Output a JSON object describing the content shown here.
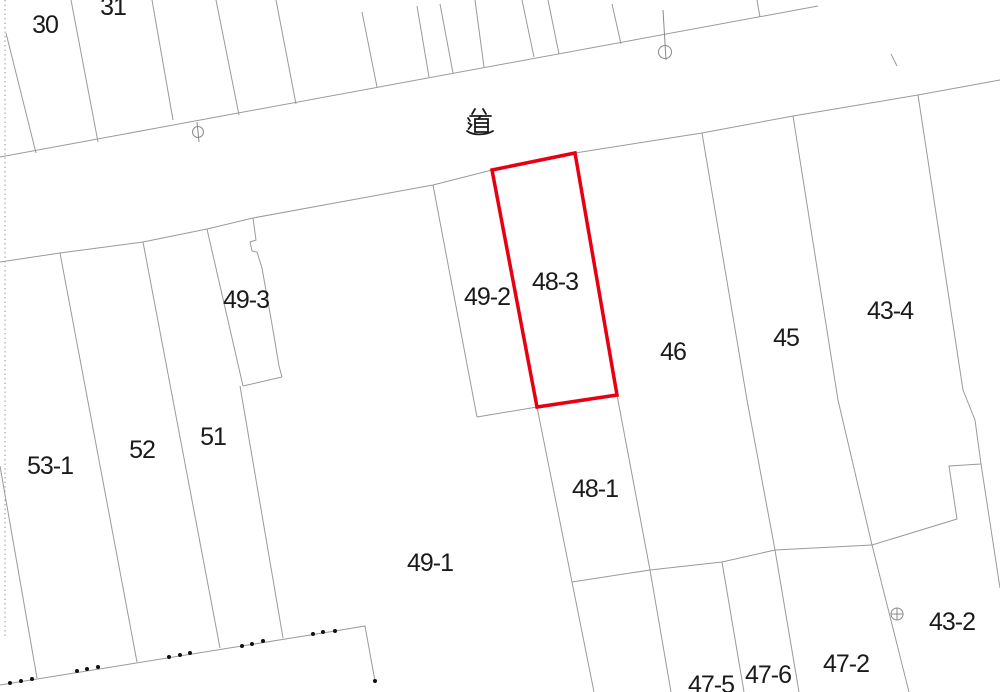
{
  "map": {
    "type": "cadastral-parcel-map",
    "road_label": {
      "text": "道",
      "x": 480,
      "y": 122
    },
    "parcel_labels": [
      {
        "id": "30",
        "text": "30",
        "x": 45,
        "y": 25
      },
      {
        "id": "31",
        "text": "31",
        "x": 113,
        "y": 7
      },
      {
        "id": "49-3",
        "text": "49-3",
        "x": 246,
        "y": 300
      },
      {
        "id": "49-2",
        "text": "49-2",
        "x": 487,
        "y": 297
      },
      {
        "id": "48-3",
        "text": "48-3",
        "x": 555,
        "y": 282
      },
      {
        "id": "46",
        "text": "46",
        "x": 673,
        "y": 352
      },
      {
        "id": "45",
        "text": "45",
        "x": 786,
        "y": 338
      },
      {
        "id": "43-4",
        "text": "43-4",
        "x": 890,
        "y": 311
      },
      {
        "id": "53-1",
        "text": "53-1",
        "x": 50,
        "y": 466
      },
      {
        "id": "52",
        "text": "52",
        "x": 142,
        "y": 450
      },
      {
        "id": "51",
        "text": "51",
        "x": 213,
        "y": 437
      },
      {
        "id": "49-1",
        "text": "49-1",
        "x": 430,
        "y": 563
      },
      {
        "id": "48-1",
        "text": "48-1",
        "x": 595,
        "y": 489
      },
      {
        "id": "43-2",
        "text": "43-2",
        "x": 952,
        "y": 622
      },
      {
        "id": "47-2",
        "text": "47-2",
        "x": 846,
        "y": 664
      },
      {
        "id": "47-6",
        "text": "47-6",
        "x": 768,
        "y": 675
      },
      {
        "id": "47-5",
        "text": "47-5",
        "x": 711,
        "y": 685
      }
    ],
    "highlight_parcel": {
      "id": "48-3",
      "color": "#e60012",
      "stroke_width": 3.5,
      "points": [
        [
          492,
          170
        ],
        [
          575,
          153
        ],
        [
          617,
          395
        ],
        [
          537,
          407
        ]
      ]
    },
    "markers": [
      {
        "type": "utility-pole-marker",
        "cx": 198,
        "cy": 132,
        "r": 5.5,
        "line": [
          [
            197,
            122
          ],
          [
            199,
            142
          ]
        ]
      },
      {
        "type": "utility-pole-marker",
        "cx": 665,
        "cy": 52,
        "r": 6.5,
        "line": [
          [
            663,
            10
          ],
          [
            666,
            60
          ]
        ]
      },
      {
        "type": "benchmark-cross-marker",
        "cx": 897,
        "cy": 614,
        "r": 6,
        "cross": true
      }
    ],
    "boundary_lines": [
      {
        "name": "road-top-edge",
        "points": [
          [
            0,
            157
          ],
          [
            818,
            6
          ]
        ]
      },
      {
        "name": "road-bottom-edge-west",
        "points": [
          [
            0,
            262
          ],
          [
            60,
            253
          ],
          [
            143,
            242
          ],
          [
            207,
            229
          ],
          [
            253,
            218
          ],
          [
            433,
            185
          ],
          [
            492,
            170
          ]
        ]
      },
      {
        "name": "road-bottom-edge-east",
        "points": [
          [
            575,
            153
          ],
          [
            702,
            133
          ],
          [
            793,
            116
          ],
          [
            918,
            95
          ],
          [
            1000,
            80
          ]
        ]
      },
      {
        "name": "upper-parcel-line-1",
        "points": [
          [
            6,
            33
          ],
          [
            36,
            153
          ]
        ]
      },
      {
        "name": "upper-parcel-line-2",
        "points": [
          [
            71,
            0
          ],
          [
            98,
            142
          ]
        ]
      },
      {
        "name": "upper-parcel-line-3",
        "points": [
          [
            152,
            0
          ],
          [
            173,
            120
          ]
        ]
      },
      {
        "name": "upper-parcel-line-4",
        "points": [
          [
            216,
            0
          ],
          [
            239,
            115
          ]
        ]
      },
      {
        "name": "upper-parcel-line-5",
        "points": [
          [
            276,
            0
          ],
          [
            296,
            104
          ]
        ]
      },
      {
        "name": "upper-parcel-line-6",
        "points": [
          [
            362,
            12
          ],
          [
            377,
            87
          ]
        ]
      },
      {
        "name": "upper-parcel-line-7",
        "points": [
          [
            417,
            6
          ],
          [
            429,
            77
          ]
        ]
      },
      {
        "name": "upper-parcel-line-8",
        "points": [
          [
            440,
            4
          ],
          [
            453,
            73
          ]
        ]
      },
      {
        "name": "upper-parcel-line-9",
        "points": [
          [
            475,
            0
          ],
          [
            484,
            67
          ]
        ]
      },
      {
        "name": "upper-parcel-line-10",
        "points": [
          [
            522,
            0
          ],
          [
            534,
            57
          ]
        ]
      },
      {
        "name": "upper-parcel-line-11",
        "points": [
          [
            548,
            0
          ],
          [
            559,
            54
          ]
        ]
      },
      {
        "name": "upper-parcel-line-12",
        "points": [
          [
            612,
            4
          ],
          [
            621,
            44
          ]
        ]
      },
      {
        "name": "upper-parcel-line-13",
        "points": [
          [
            757,
            0
          ],
          [
            760,
            17
          ]
        ]
      },
      {
        "name": "road-inner-tick",
        "points": [
          [
            891,
            54
          ],
          [
            897,
            66
          ]
        ]
      },
      {
        "name": "parcel-53-1-west",
        "points": [
          [
            0,
            466
          ],
          [
            37,
            678
          ]
        ]
      },
      {
        "name": "parcel-53-1-52",
        "points": [
          [
            60,
            253
          ],
          [
            137,
            662
          ]
        ]
      },
      {
        "name": "parcel-52-51",
        "points": [
          [
            143,
            242
          ],
          [
            220,
            648
          ]
        ]
      },
      {
        "name": "parcel-49-3-left",
        "points": [
          [
            207,
            229
          ],
          [
            243,
            386
          ]
        ]
      },
      {
        "name": "parcel-49-3-right",
        "points": [
          [
            253,
            218
          ],
          [
            256,
            240
          ],
          [
            250,
            242
          ],
          [
            252,
            251
          ],
          [
            257,
            252
          ],
          [
            262,
            268
          ],
          [
            273,
            330
          ],
          [
            279,
            366
          ],
          [
            282,
            377
          ]
        ]
      },
      {
        "name": "parcel-49-3-bottom",
        "points": [
          [
            282,
            377
          ],
          [
            243,
            386
          ]
        ]
      },
      {
        "name": "parcel-51-49-1",
        "points": [
          [
            240,
            386
          ],
          [
            283,
            638
          ]
        ]
      },
      {
        "name": "parcel-49-2-left",
        "points": [
          [
            433,
            185
          ],
          [
            477,
            417
          ]
        ]
      },
      {
        "name": "parcel-49-2-bottom",
        "points": [
          [
            477,
            417
          ],
          [
            537,
            407
          ]
        ]
      },
      {
        "name": "parcel-49-1-48-1",
        "points": [
          [
            537,
            407
          ],
          [
            594,
            692
          ]
        ]
      },
      {
        "name": "parcel-48-1-east",
        "points": [
          [
            617,
            395
          ],
          [
            650,
            570
          ],
          [
            671,
            692
          ]
        ]
      },
      {
        "name": "parcel-46-45",
        "points": [
          [
            702,
            133
          ],
          [
            747,
            400
          ],
          [
            775,
            550
          ],
          [
            799,
            692
          ]
        ]
      },
      {
        "name": "parcel-45-43-4",
        "points": [
          [
            793,
            116
          ],
          [
            838,
            400
          ],
          [
            872,
            545
          ],
          [
            909,
            692
          ]
        ]
      },
      {
        "name": "parcel-43-4-east",
        "points": [
          [
            918,
            95
          ],
          [
            963,
            390
          ],
          [
            975,
            420
          ],
          [
            981,
            464
          ],
          [
            1000,
            588
          ]
        ]
      },
      {
        "name": "parcel-43-4-notch",
        "points": [
          [
            981,
            464
          ],
          [
            949,
            466
          ],
          [
            957,
            519
          ]
        ]
      },
      {
        "name": "block-47-top",
        "points": [
          [
            572,
            582
          ],
          [
            650,
            570
          ],
          [
            722,
            562
          ],
          [
            775,
            550
          ],
          [
            872,
            545
          ],
          [
            957,
            519
          ]
        ]
      },
      {
        "name": "parcel-47-5-47-6",
        "points": [
          [
            722,
            562
          ],
          [
            744,
            692
          ]
        ]
      },
      {
        "name": "surveyed-edge",
        "points": [
          [
            0,
            685
          ],
          [
            335,
            631
          ],
          [
            365,
            626
          ],
          [
            375,
            681
          ]
        ]
      }
    ],
    "dotted_boundary": {
      "name": "sheet-edge-dotted-line",
      "points": [
        [
          5,
          0
        ],
        [
          5,
          636
        ]
      ]
    },
    "survey_dots": [
      [
        10,
        683
      ],
      [
        21,
        681
      ],
      [
        32,
        679
      ],
      [
        77,
        671
      ],
      [
        87,
        669
      ],
      [
        98,
        667
      ],
      [
        169,
        657
      ],
      [
        180,
        655
      ],
      [
        190,
        653
      ],
      [
        242,
        646
      ],
      [
        252,
        644
      ],
      [
        263,
        641
      ],
      [
        313,
        634
      ],
      [
        323,
        632
      ],
      [
        335,
        631
      ],
      [
        375,
        681
      ]
    ],
    "style": {
      "background": "#ffffff",
      "line_color": "#9a9a9a",
      "marker_color": "#8a8a8a",
      "text_color": "#1a1a1a",
      "dot_color": "#111111",
      "label_font_size": 25
    }
  }
}
